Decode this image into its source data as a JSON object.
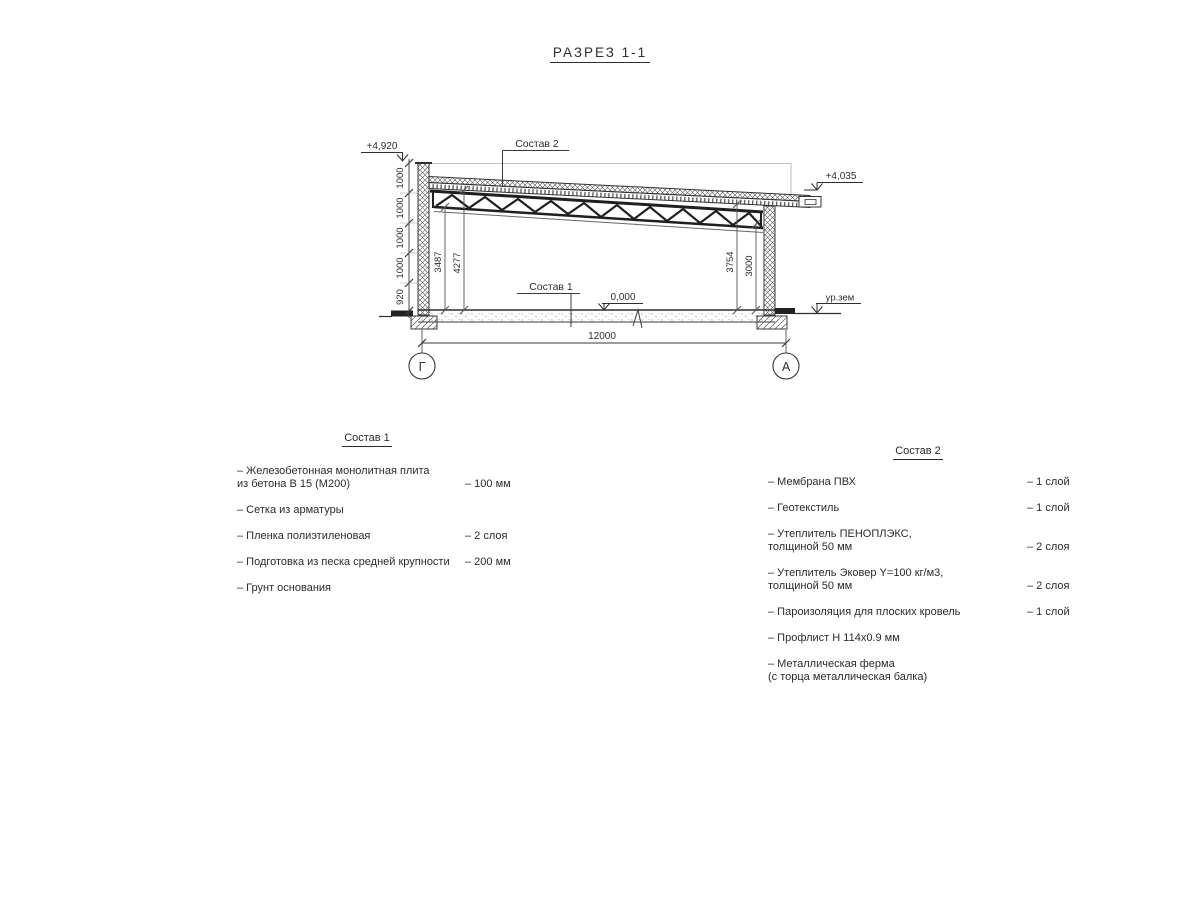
{
  "title": "РАЗРЕЗ 1-1",
  "section": {
    "elevation_top_left": "+4,920",
    "elevation_top_right": "+4,035",
    "elevation_floor": "0,000",
    "ground_label": "ур.зем",
    "callout_roof": "Состав 2",
    "callout_floor": "Состав 1",
    "dim_chain_left": [
      "1000",
      "1000",
      "1000",
      "1000",
      "920"
    ],
    "dim_interior_left": [
      "3487",
      "4277"
    ],
    "dim_interior_right": [
      "3754",
      "3000"
    ],
    "dim_span": "12000",
    "axis_left": "Г",
    "axis_right": "А"
  },
  "composition1": {
    "title": "Состав 1",
    "items": [
      {
        "line1": "– Железобетонная монолитная плита",
        "line2": "из бетона В 15 (М200)",
        "value": "– 100 мм"
      },
      {
        "line1": "– Сетка из арматуры",
        "line2": "",
        "value": ""
      },
      {
        "line1": "– Пленка полиэтиленовая",
        "line2": "",
        "value": "– 2 слоя"
      },
      {
        "line1": "– Подготовка из песка средней крупности",
        "line2": "",
        "value": "– 200 мм"
      },
      {
        "line1": "– Грунт основания",
        "line2": "",
        "value": ""
      }
    ]
  },
  "composition2": {
    "title": "Состав 2",
    "items": [
      {
        "line1": "– Мембрана ПВХ",
        "line2": "",
        "value": "– 1 слой"
      },
      {
        "line1": "– Геотекстиль",
        "line2": "",
        "value": "– 1 слой"
      },
      {
        "line1": "– Утеплитель ПЕНОПЛЭКС,",
        "line2": "толщиной 50 мм",
        "value": "– 2 слоя"
      },
      {
        "line1": "– Утеплитель Эковер Y=100 кг/м3,",
        "line2": "толщиной 50 мм",
        "value": "– 2 слоя"
      },
      {
        "line1": "– Пароизоляция для плоских кровель",
        "line2": "",
        "value": "– 1 слой"
      },
      {
        "line1": "– Профлист Н 114х0.9 мм",
        "line2": "",
        "value": ""
      },
      {
        "line1": "– Металлическая ферма",
        "line2": "(с торца металлическая балка)",
        "value": ""
      }
    ]
  },
  "colors": {
    "ink": "#2e2e2e",
    "line": "#3a3a3a",
    "light_line": "#aaaaaa",
    "background": "#ffffff"
  }
}
